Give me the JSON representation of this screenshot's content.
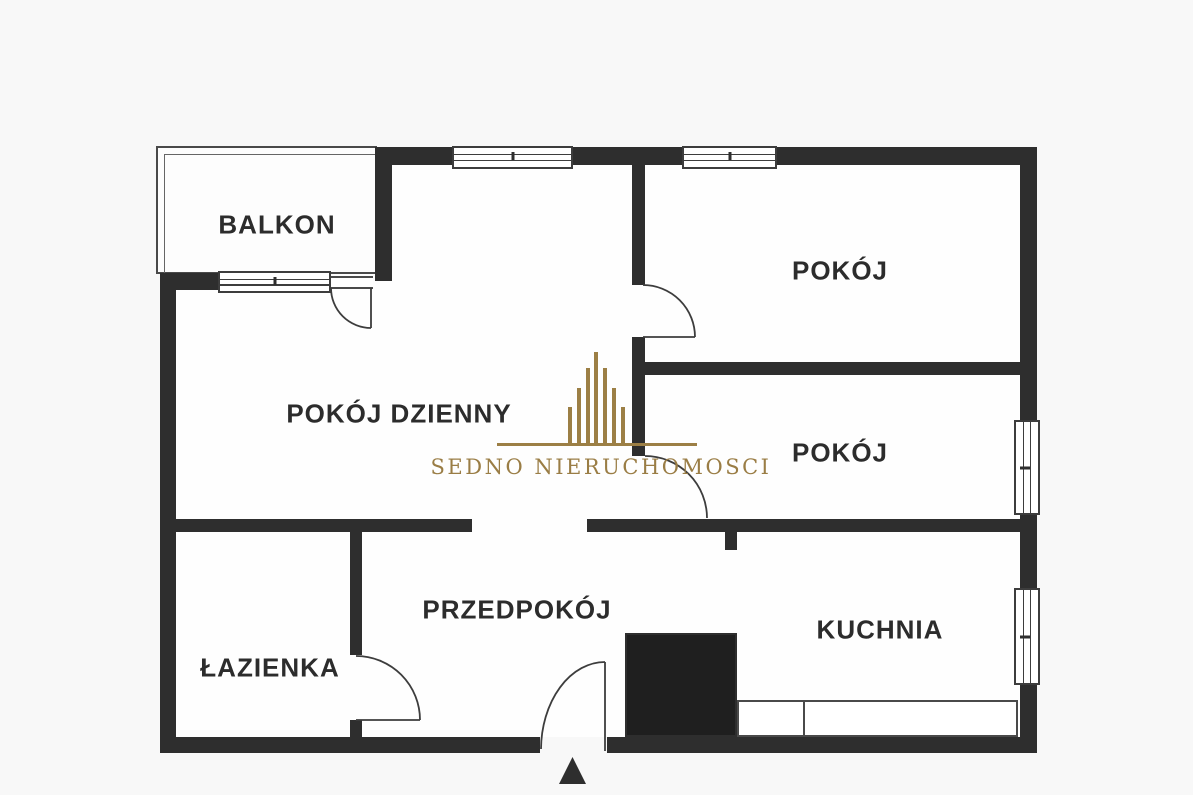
{
  "floor_plan": {
    "title_hint": "apartment floor plan",
    "rooms": [
      {
        "id": "balkon",
        "label": "BALKON"
      },
      {
        "id": "pokoj-dzienny",
        "label": "POKÓJ DZIENNY"
      },
      {
        "id": "pokoj-gorny",
        "label": "POKÓJ"
      },
      {
        "id": "pokoj-srodkowy",
        "label": "POKÓJ"
      },
      {
        "id": "przedpokoj",
        "label": "PRZEDPOKÓJ"
      },
      {
        "id": "lazienka",
        "label": "ŁAZIENKA"
      },
      {
        "id": "kuchnia",
        "label": "KUCHNIA"
      }
    ],
    "watermark": {
      "text": "SEDNO NIERUCHOMOSCI"
    },
    "icons": {
      "entrance_arrow": "▲",
      "logo_mark": "gold building-skyline bars"
    },
    "colors": {
      "wall": "#2e2e2e",
      "shaft_fill": "#1f1f1f",
      "gold": "#9c7f45",
      "label_text": "#2c2c2c",
      "background": "#f8f8f8"
    }
  }
}
